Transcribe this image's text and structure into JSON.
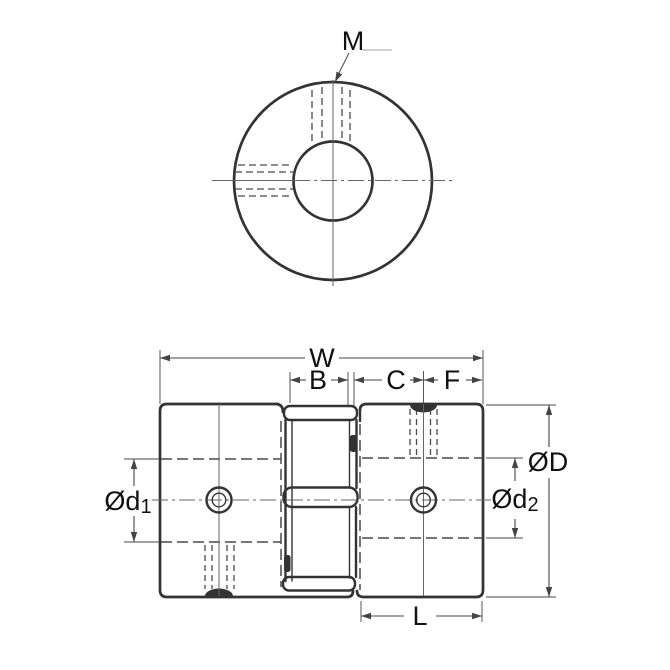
{
  "drawing_title": "jaw-coupling-technical-drawing",
  "labels": {
    "set_screw_thread": "M",
    "total_width": "W",
    "jaw_section_width": "B",
    "hub_to_screw": "C",
    "screw_to_end": "F",
    "outer_diameter_prefix": "Ø",
    "outer_diameter_letter": "D",
    "bore_left_prefix": "Ød",
    "bore_left_sub": "1",
    "bore_right_prefix": "Ød",
    "bore_right_sub": "2",
    "hub_length": "L"
  },
  "colors": {
    "line": "#333333",
    "thin": "#666666",
    "hidden": "#4a4a4a",
    "dim": "#444444",
    "text": "#111111",
    "background": "#ffffff"
  }
}
